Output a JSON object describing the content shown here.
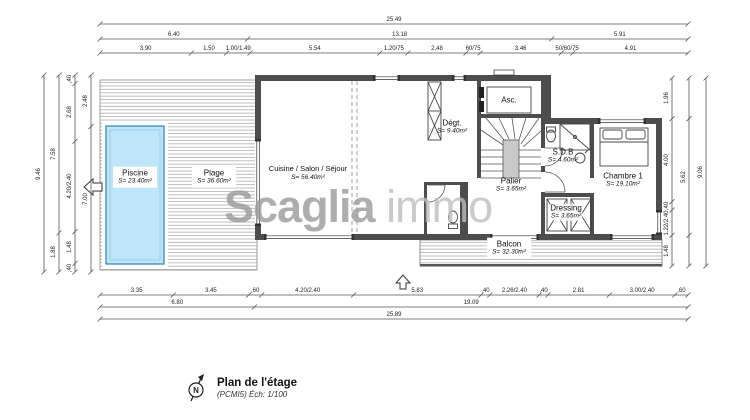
{
  "watermark": {
    "bold": "Scaglia",
    "light": "immo",
    "color_bold": "#9a9a9a",
    "color_light": "#bdbdbd"
  },
  "legend": {
    "title": "Plan de l'étage",
    "subtitle": "(PCMI5) Éch: 1/100",
    "north_letter": "N"
  },
  "colors": {
    "wall": "#4d4d4d",
    "pool_fill": "#bfe6f8",
    "pool_border": "#2e7fb0",
    "deck_line": "#a3a3a3",
    "dimension": "#555555"
  },
  "icons": {
    "north": "compass-north-arrow",
    "entry_left": "block-arrow-left",
    "entry_up": "block-arrow-up"
  },
  "rooms": {
    "piscine": {
      "name": "Piscine",
      "area": "S= 23.40m²"
    },
    "plage": {
      "name": "Plage",
      "area": "S= 36.60m²"
    },
    "cuisine": {
      "name": "Cuisine / Salon / Séjour",
      "area": "S= 56.40m²"
    },
    "degt": {
      "name": "Dégt.",
      "area": "S= 9.40m²"
    },
    "asc": {
      "name": "Asc."
    },
    "palier": {
      "name": "Palier",
      "area": "S= 3.65m²"
    },
    "sdb": {
      "name": "S.D.B",
      "area": "S= 4.60m²"
    },
    "chambre1": {
      "name": "Chambre 1",
      "area": "S= 19.10m²"
    },
    "dressing": {
      "name": "Dressing",
      "area": "S= 3.65m²"
    },
    "balcon": {
      "name": "Balcon",
      "area": "S= 32.30m²"
    }
  },
  "dimensions": {
    "top_rows": [
      {
        "segments": [
          {
            "m": 25.49,
            "label": "25.49"
          }
        ]
      },
      {
        "segments": [
          {
            "m": 6.4,
            "label": "6.40"
          },
          {
            "m": 13.18,
            "label": "13.18"
          },
          {
            "m": 5.91,
            "label": "5.91"
          }
        ]
      },
      {
        "segments": [
          {
            "m": 3.9,
            "label": "3.90"
          },
          {
            "m": 1.5,
            "label": "1.50"
          },
          {
            "m": 1.0,
            "label": "1.00/1.49"
          },
          {
            "m": 5.54,
            "label": "5.54"
          },
          {
            "m": 1.2,
            "label": "1.20/75"
          },
          {
            "m": 2.48,
            "label": "2.48"
          },
          {
            "m": 0.6,
            "label": "60/75"
          },
          {
            "m": 3.46,
            "label": "3.46"
          },
          {
            "m": 0.5,
            "label": "50/60/75"
          },
          {
            "m": 4.91,
            "label": "4.91"
          }
        ]
      }
    ],
    "bottom_rows": [
      {
        "segments": [
          {
            "m": 3.35,
            "label": "3.35"
          },
          {
            "m": 3.45,
            "label": "3.45"
          },
          {
            "m": 0.6,
            "label": ",60"
          },
          {
            "m": 4.2,
            "label": "4.20/2.40"
          },
          {
            "m": 5.83,
            "label": "5.83"
          },
          {
            "m": 0.4,
            "label": ",40"
          },
          {
            "m": 2.26,
            "label": "2.26/2.40"
          },
          {
            "m": 0.4,
            "label": ",40"
          },
          {
            "m": 2.81,
            "label": "2.81"
          },
          {
            "m": 3.0,
            "label": "3.00/2.40"
          },
          {
            "m": 0.6,
            "label": ",60"
          }
        ]
      },
      {
        "segments": [
          {
            "m": 6.8,
            "label": "6.80"
          },
          {
            "m": 19.09,
            "label": "19.09"
          }
        ]
      },
      {
        "segments": [
          {
            "m": 25.89,
            "label": "25.89"
          }
        ]
      }
    ],
    "left_cols": [
      {
        "segments": [
          {
            "m": 9.46,
            "label": "9.46"
          }
        ]
      },
      {
        "segments": [
          {
            "m": 7.58,
            "label": "7.58"
          },
          {
            "m": 1.88,
            "label": "1.88"
          }
        ]
      },
      {
        "segments": [
          {
            "m": 0.4,
            "label": ",40"
          },
          {
            "m": 2.68,
            "label": "2.68"
          },
          {
            "m": 4.2,
            "label": "4.20/2.40"
          },
          {
            "m": 1.48,
            "label": "1.48"
          },
          {
            "m": 0.4,
            "label": ",40"
          }
        ]
      },
      {
        "segments": [
          {
            "m": 2.48,
            "label": "2.48"
          },
          {
            "m": 7.0,
            "label": "7.00"
          }
        ]
      }
    ],
    "right_cols": [
      {
        "segments": [
          {
            "m": 1.96,
            "label": "1.96"
          },
          {
            "m": 4.0,
            "label": "4.00"
          },
          {
            "m": 0.4,
            "label": ",40"
          },
          {
            "m": 1.22,
            "label": "1.22/2.40"
          },
          {
            "m": 1.48,
            "label": "1.48"
          }
        ]
      },
      {
        "segments": [
          {
            "m": 1.96,
            "label": ""
          },
          {
            "m": 5.62,
            "label": "5.62"
          },
          {
            "m": 1.48,
            "label": ""
          }
        ]
      },
      {
        "segments": [
          {
            "m": 9.06,
            "label": "9.06"
          }
        ]
      }
    ]
  }
}
